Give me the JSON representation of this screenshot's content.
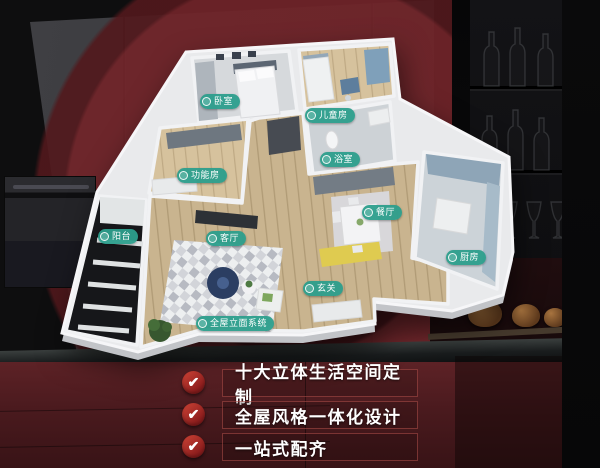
{
  "floorplan": {
    "labels": [
      {
        "name": "bedroom",
        "text": "卧室"
      },
      {
        "name": "children-room",
        "text": "儿童房"
      },
      {
        "name": "function-room",
        "text": "功能房"
      },
      {
        "name": "bathroom",
        "text": "浴室"
      },
      {
        "name": "balcony",
        "text": "阳台"
      },
      {
        "name": "living-room",
        "text": "客厅"
      },
      {
        "name": "dining-room",
        "text": "餐厅"
      },
      {
        "name": "kitchen",
        "text": "厨房"
      },
      {
        "name": "entrance",
        "text": "玄关"
      },
      {
        "name": "elevation-system",
        "text": "全屋立面系统"
      }
    ]
  },
  "checklist": {
    "check_icon": "✔",
    "items": [
      {
        "text": "十大立体生活空间定制"
      },
      {
        "text": "全屋风格一体化设计"
      },
      {
        "text": "一站式配齐"
      }
    ]
  },
  "colors": {
    "label_teal": "#2c9e8c",
    "check_red": "#c0342c",
    "ring_red": "#712429",
    "cabinet_maroon": "#5d2226",
    "panel_grey": "#3a3a3e"
  }
}
